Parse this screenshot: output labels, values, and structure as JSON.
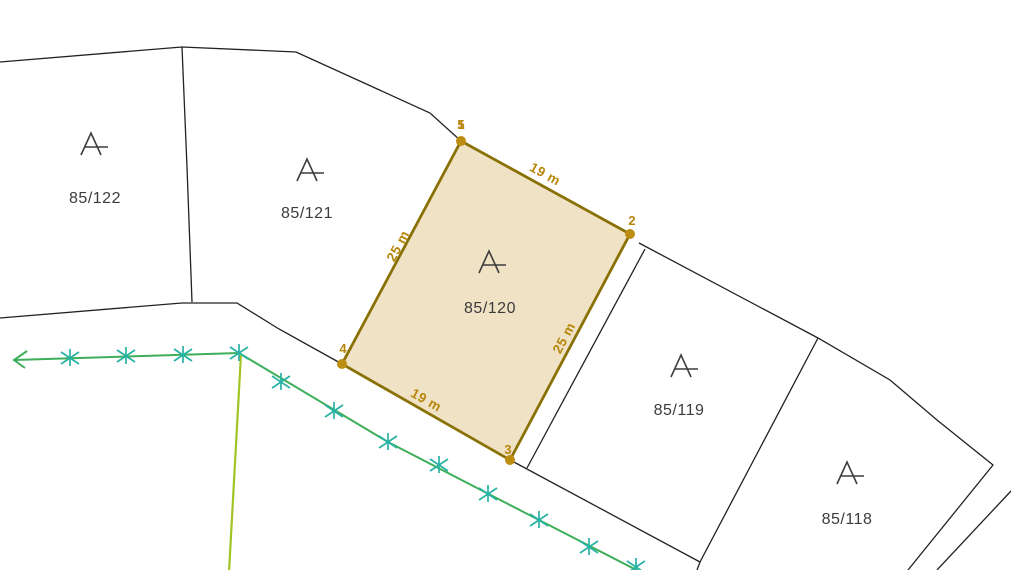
{
  "map": {
    "colors": {
      "background": "#ffffff",
      "boundary_line": "#222222",
      "parcel_text": "#3c3c3c",
      "parcel_symbol": "#3c3c3c",
      "highlight_fill": "#efe2c5",
      "highlight_edge": "#8a7106",
      "highlight_point": "#bd8d11",
      "highlight_text": "#b8860b",
      "survey_line": "#3fae5a",
      "survey_line_secondary": "#a2c426",
      "survey_mark": "#27b2a4"
    },
    "parcels": [
      {
        "number": "85/122",
        "symbol": "A"
      },
      {
        "number": "85/121",
        "symbol": "A"
      },
      {
        "number": "85/120",
        "symbol": "A"
      },
      {
        "number": "85/119",
        "symbol": "A"
      },
      {
        "number": "85/118",
        "symbol": "A"
      }
    ],
    "highlighted_parcel": {
      "vertices": [
        {
          "label": "1"
        },
        {
          "label": "5"
        },
        {
          "label": "2"
        },
        {
          "label": "3"
        },
        {
          "label": "4"
        }
      ],
      "edges": [
        {
          "length": "19 m"
        },
        {
          "length": "25 m"
        },
        {
          "length": "25 m"
        },
        {
          "length": "19 m"
        }
      ]
    }
  }
}
